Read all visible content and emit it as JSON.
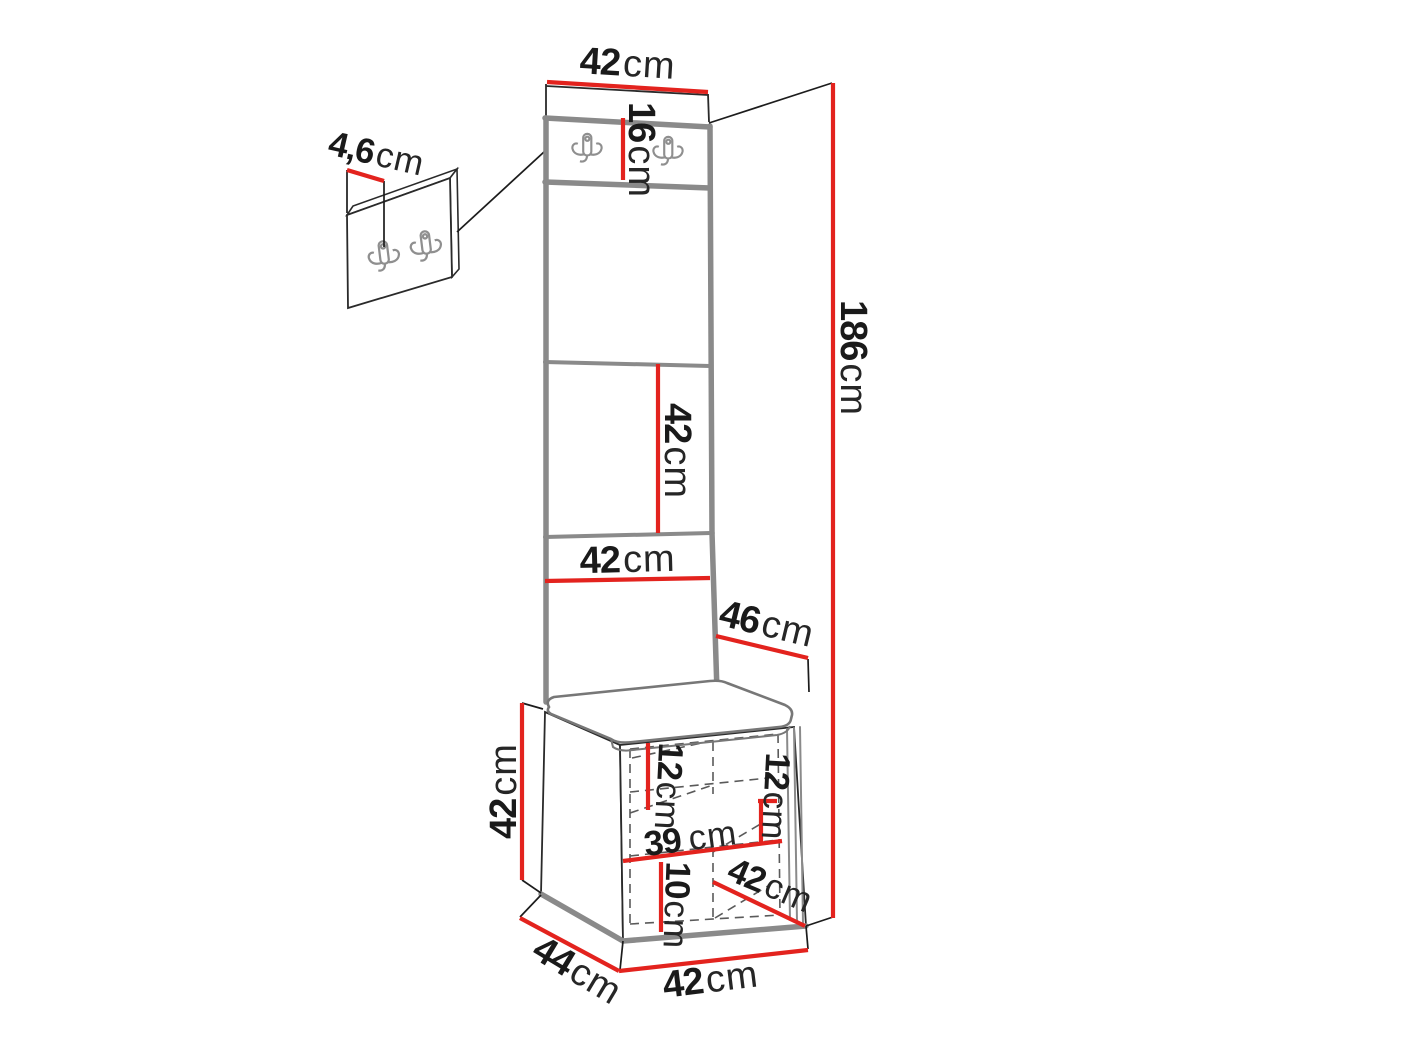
{
  "colors": {
    "dimension_red": "#e3231e",
    "outline_black": "#1c1c1c",
    "panel_edge_gray": "#8a8a8a"
  },
  "dims": {
    "top_width": {
      "num": "42",
      "unit": "cm"
    },
    "hook_panel_height": {
      "num": "16",
      "unit": "cm"
    },
    "hook_panel_thickness": {
      "num": "4,6",
      "unit": "cm"
    },
    "total_height": {
      "num": "186",
      "unit": "cm"
    },
    "upper_panel_height": {
      "num": "42",
      "unit": "cm"
    },
    "panel_width": {
      "num": "42",
      "unit": "cm"
    },
    "top_depth": {
      "num": "46",
      "unit": "cm"
    },
    "bench_height": {
      "num": "42",
      "unit": "cm"
    },
    "bench_inner_top_left_height": {
      "num": "12",
      "unit": "cm"
    },
    "bench_inner_top_right_height": {
      "num": "12",
      "unit": "cm"
    },
    "bench_inner_width": {
      "num": "39",
      "unit": "cm"
    },
    "bench_inner_bottom_height": {
      "num": "10",
      "unit": "cm"
    },
    "bench_inner_depth": {
      "num": "42",
      "unit": "cm"
    },
    "bench_base_depth": {
      "num": "44",
      "unit": "cm"
    },
    "bench_base_width": {
      "num": "42",
      "unit": "cm"
    }
  }
}
